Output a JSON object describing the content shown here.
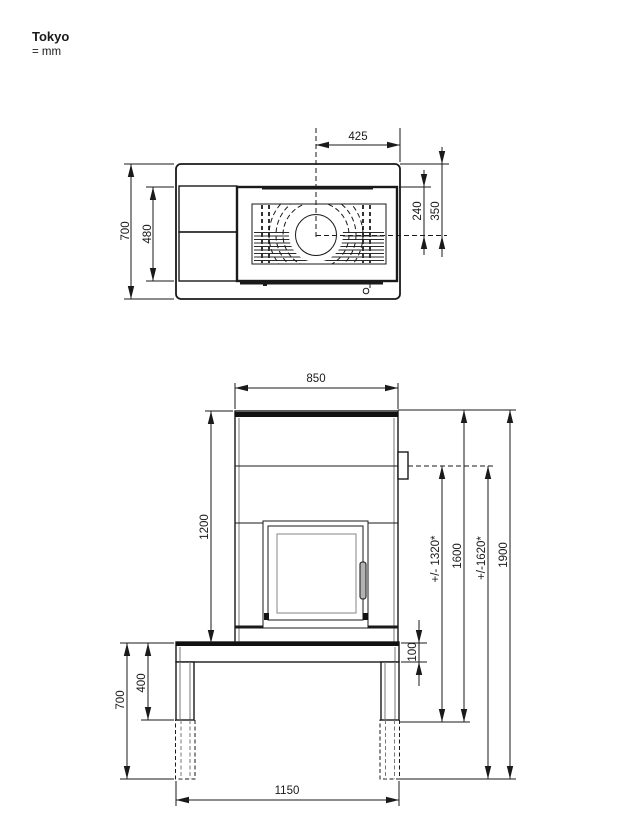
{
  "title": "Tokyo",
  "units": "= mm",
  "top_view": {
    "flue_offset": "425",
    "total_depth": "700",
    "body_depth": "480",
    "flue_from_back": "240",
    "flue_from_outer": "350"
  },
  "front_view": {
    "body_width": "850",
    "body_height": "1200",
    "flue_height_std": "+/- 1320*",
    "total_height_std": "1600",
    "flue_height_ext": "+/-1620*",
    "total_height_ext": "1900",
    "bench_thickness": "100",
    "leg_height_std": "400",
    "leg_height_ext": "700",
    "base_width": "1150"
  },
  "colors": {
    "line": "#1a1a1a",
    "grill_fill": "#bdbdbd",
    "glass_line": "#999999",
    "handle_fill": "#b3b3b3"
  }
}
